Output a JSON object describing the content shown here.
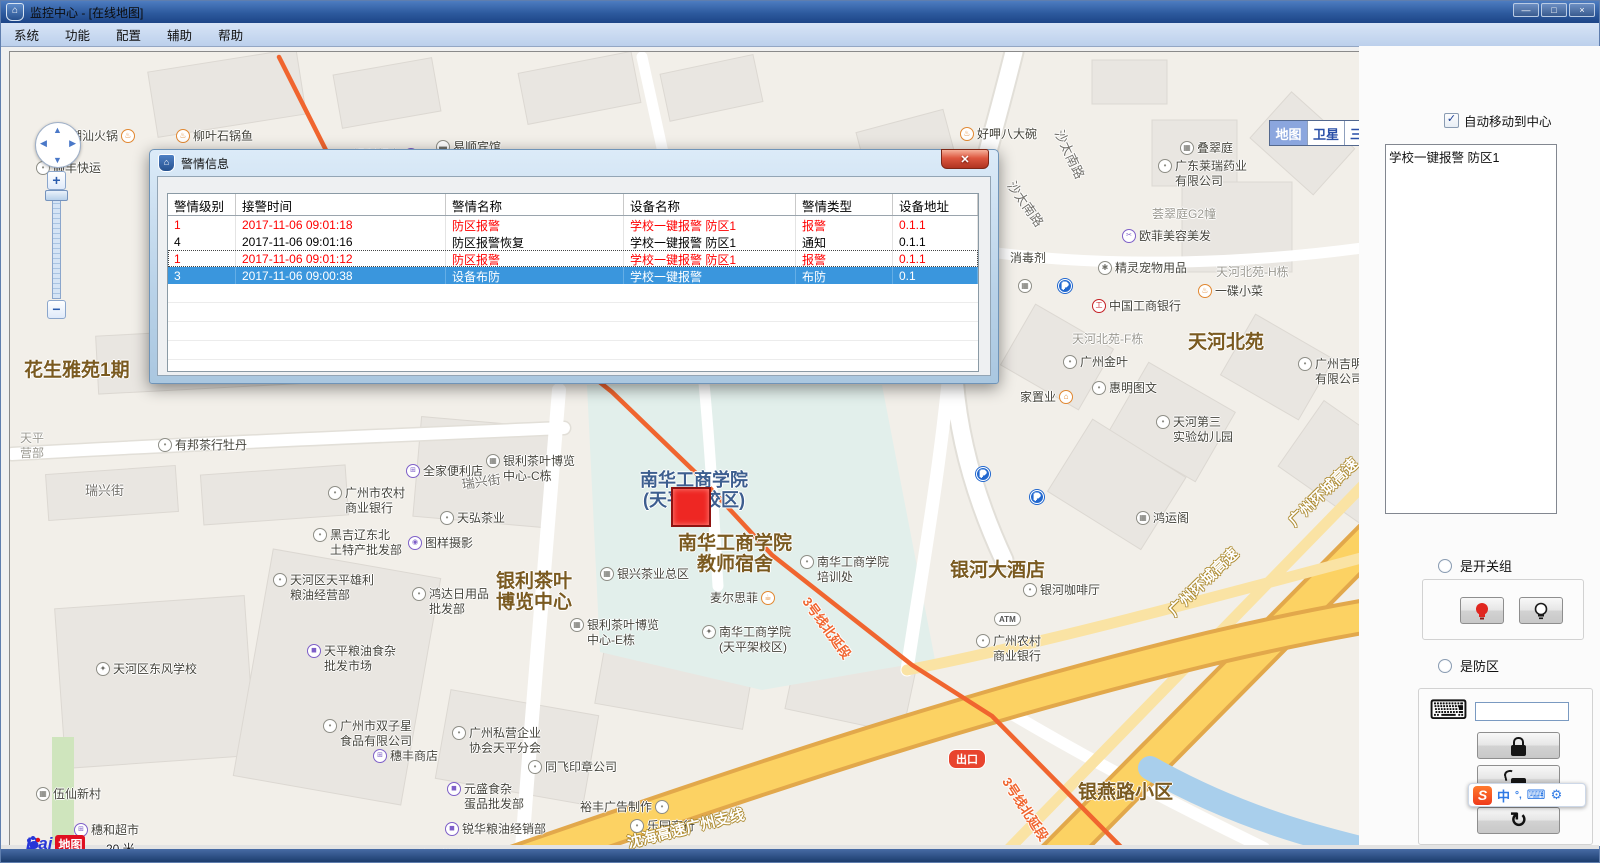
{
  "window": {
    "title": "监控中心 - [在线地图]",
    "controls": {
      "minimize": "—",
      "maximize": "□",
      "close": "×"
    }
  },
  "menu": {
    "items": [
      "系统",
      "功能",
      "配置",
      "辅助",
      "帮助"
    ]
  },
  "map": {
    "view_buttons": [
      {
        "label": "地图",
        "active": true
      },
      {
        "label": "卫星",
        "active": false
      },
      {
        "label": "三维",
        "active": false
      }
    ],
    "zoom_plus": "+",
    "zoom_minus": "−",
    "logo": {
      "bai": "Bai",
      "ditu": "地图"
    },
    "scale_label": "20 米",
    "copyright": "© 2017 Baidu - GS(2016)2089号 - 甲测资字1100930 - 京ICP证030173号 - Data © 长地万方",
    "marker_color": "#ee2723",
    "metro_color": "#f0652f",
    "highway_color": "#fcd263",
    "labels": [
      {
        "t": "潮汕火锅",
        "x": 60,
        "y": 86,
        "i": "food",
        "s": "r"
      },
      {
        "t": "柳叶石锅鱼",
        "x": 166,
        "y": 86,
        "i": "food"
      },
      {
        "t": "顺丰快运",
        "x": 26,
        "y": 118,
        "i": "dot"
      },
      {
        "t": "点心哥哥",
        "x": 196,
        "y": 133,
        "i": "food",
        "s": "r"
      },
      {
        "t": "美宜佳",
        "x": 282,
        "y": 145,
        "i": "bag",
        "s": "r"
      },
      {
        "t": "银利超市",
        "x": 343,
        "y": 105,
        "i": "bag",
        "s": "r"
      },
      {
        "t": "名城休闲会所",
        "x": 348,
        "y": 131,
        "i": "dot"
      },
      {
        "t": "易顺宾馆",
        "x": 426,
        "y": 97,
        "i": "bed"
      },
      {
        "t": "老三修理店",
        "x": 528,
        "y": 109,
        "i": "car"
      },
      {
        "t": "化隆牛肉面",
        "x": 556,
        "y": 143,
        "i": "food"
      },
      {
        "t": "好呷八大碗",
        "x": 950,
        "y": 84,
        "i": "food"
      },
      {
        "t": "叠翠庭",
        "x": 1170,
        "y": 98,
        "i": "bld"
      },
      {
        "t": "广东莱瑞药业\n有限公司",
        "x": 1148,
        "y": 116,
        "i": "dot"
      },
      {
        "t": "荟翠庭G2幢",
        "x": 1142,
        "y": 164,
        "c": "gray"
      },
      {
        "t": "欧菲美容美发",
        "x": 1112,
        "y": 186,
        "i": "cut"
      },
      {
        "t": "消毒剂",
        "x": 1000,
        "y": 208
      },
      {
        "t": "精灵宠物用品",
        "x": 1088,
        "y": 218,
        "i": "paw"
      },
      {
        "t": "天河北苑-H栋",
        "x": 1206,
        "y": 222,
        "c": "gray"
      },
      {
        "t": "一碟小菜",
        "x": 1188,
        "y": 241,
        "i": "food"
      },
      {
        "t": "中国工商银行",
        "x": 1082,
        "y": 256,
        "i": "icbc"
      },
      {
        "t": "天河北苑-F栋",
        "x": 1062,
        "y": 289,
        "c": "gray"
      },
      {
        "t": "天河北苑",
        "x": 1178,
        "y": 290,
        "c": "big"
      },
      {
        "t": "广州金叶",
        "x": 1053,
        "y": 312,
        "i": "dot"
      },
      {
        "t": "惠明图文",
        "x": 1082,
        "y": 338,
        "i": "dot"
      },
      {
        "t": "家置业",
        "x": 1010,
        "y": 347,
        "i": "home",
        "s": "r"
      },
      {
        "t": "天河第三\n实验幼儿园",
        "x": 1146,
        "y": 372,
        "i": "dot"
      },
      {
        "t": "广州吉明电子科技\n有限公司",
        "x": 1288,
        "y": 314,
        "i": "dot"
      },
      {
        "t": "鸿运阁",
        "x": 1126,
        "y": 468,
        "i": "bld"
      },
      {
        "t": "花生雅苑1期",
        "x": 14,
        "y": 318,
        "c": "big"
      },
      {
        "t": "天平\n营部",
        "x": 10,
        "y": 388,
        "c": "gray"
      },
      {
        "t": "瑞兴街",
        "x": 75,
        "y": 440,
        "c": "road"
      },
      {
        "t": "瑞兴街",
        "x": 452,
        "y": 434,
        "c": "road",
        "r": -8
      },
      {
        "t": "有邦茶行牡丹",
        "x": 148,
        "y": 395,
        "i": "dot"
      },
      {
        "t": "广州市农村\n商业银行",
        "x": 318,
        "y": 443,
        "i": "dot"
      },
      {
        "t": "黑吉辽东北\n土特产批发部",
        "x": 303,
        "y": 485,
        "i": "dot"
      },
      {
        "t": "天河区天平雄利\n粮油经营部",
        "x": 263,
        "y": 530,
        "i": "dot"
      },
      {
        "t": "全家便利店",
        "x": 396,
        "y": 421,
        "i": "cart"
      },
      {
        "t": "银利茶叶博览\n中心-C栋",
        "x": 476,
        "y": 411,
        "i": "bld"
      },
      {
        "t": "天弘茶业",
        "x": 430,
        "y": 468,
        "i": "dot"
      },
      {
        "t": "图样摄影",
        "x": 398,
        "y": 493,
        "i": "camera"
      },
      {
        "t": "银利茶叶\n博览中心",
        "x": 486,
        "y": 529,
        "c": "big"
      },
      {
        "t": "鸿达日用品\n批发部",
        "x": 402,
        "y": 544,
        "i": "dot"
      },
      {
        "t": "银兴茶业总区",
        "x": 590,
        "y": 524,
        "i": "bld"
      },
      {
        "t": "银利茶叶博览\n中心-E栋",
        "x": 560,
        "y": 575,
        "i": "bld"
      },
      {
        "t": "南华工商学院\n(天平架校区)",
        "x": 630,
        "y": 427,
        "c": "big2"
      },
      {
        "t": "南华工商学院\n教师宿舍",
        "x": 668,
        "y": 491,
        "c": "big"
      },
      {
        "t": "麦尔思菲",
        "x": 700,
        "y": 548,
        "i": "coffee",
        "s": "r"
      },
      {
        "t": "南华工商学院\n培训处",
        "x": 790,
        "y": 512,
        "i": "dot"
      },
      {
        "t": "南华工商学院\n(天平架校区)",
        "x": 692,
        "y": 582,
        "i": "school"
      },
      {
        "t": "银河大酒店",
        "x": 940,
        "y": 518,
        "c": "big"
      },
      {
        "t": "银河咖啡厅",
        "x": 1013,
        "y": 540,
        "i": "dot"
      },
      {
        "t": "广州农村\n商业银行",
        "x": 966,
        "y": 591,
        "i": "dot"
      },
      {
        "t": "天平粮油食杂\n批发市场",
        "x": 297,
        "y": 601,
        "i": "bag"
      },
      {
        "t": "广州市双子星\n食品有限公司",
        "x": 313,
        "y": 676,
        "i": "dot"
      },
      {
        "t": "穗丰商店",
        "x": 363,
        "y": 706,
        "i": "cart"
      },
      {
        "t": "广州私营企业\n协会天平分会",
        "x": 442,
        "y": 683,
        "i": "dot"
      },
      {
        "t": "同飞印章公司",
        "x": 518,
        "y": 717,
        "i": "dot"
      },
      {
        "t": "元盛食杂\n蛋品批发部",
        "x": 437,
        "y": 739,
        "i": "bag"
      },
      {
        "t": "裕丰广告制作",
        "x": 570,
        "y": 757,
        "i": "dot",
        "s": "r"
      },
      {
        "t": "锐华粮油经销部",
        "x": 435,
        "y": 779,
        "i": "bag"
      },
      {
        "t": "乐园商行",
        "x": 620,
        "y": 776,
        "i": "dot"
      },
      {
        "t": "锋兴批发部",
        "x": 390,
        "y": 806,
        "i": "bag"
      },
      {
        "t": "天河区东风学校",
        "x": 86,
        "y": 619,
        "i": "school"
      },
      {
        "t": "伍仙新村",
        "x": 26,
        "y": 744,
        "i": "bld"
      },
      {
        "t": "穗和超市",
        "x": 64,
        "y": 780,
        "i": "cart"
      },
      {
        "t": "永业汽配经营部",
        "x": 872,
        "y": 812,
        "i": "car"
      },
      {
        "t": "新蕾五星学校",
        "x": 860,
        "y": 837,
        "c": "big"
      },
      {
        "t": "银燕路小区",
        "x": 1068,
        "y": 740,
        "c": "big"
      },
      {
        "t": "3号线北延段",
        "x": 795,
        "y": 548,
        "c": "metro",
        "r": 54
      },
      {
        "t": "3号线北延段",
        "x": 995,
        "y": 728,
        "c": "metro",
        "r": 57
      },
      {
        "t": "沈海高速广州支线",
        "x": 618,
        "y": 792,
        "c": "hwy",
        "r": -14
      },
      {
        "t": "广州环城高速",
        "x": 1162,
        "y": 562,
        "c": "hwy",
        "r": -44
      },
      {
        "t": "广州环城高速",
        "x": 1282,
        "y": 472,
        "c": "hwy",
        "r": -44
      },
      {
        "t": "沙太南路",
        "x": 1048,
        "y": 80,
        "c": "road",
        "r": 65
      },
      {
        "t": "沙太南路",
        "x": 1000,
        "y": 132,
        "c": "road",
        "r": 55
      },
      {
        "t": "",
        "x": 1008,
        "y": 236,
        "i": "bld"
      },
      {
        "t": "",
        "x": 1048,
        "y": 236,
        "i": "p"
      },
      {
        "t": "",
        "x": 966,
        "y": 424,
        "i": "p"
      },
      {
        "t": "",
        "x": 1020,
        "y": 447,
        "i": "p"
      }
    ],
    "atm_badge": {
      "t": "ATM",
      "x": 984,
      "y": 560
    },
    "exit_badge": {
      "t": "出口",
      "x": 938,
      "y": 697
    }
  },
  "dialog": {
    "title": "警情信息",
    "close_glyph": "✕",
    "columns": [
      "警情级别",
      "接警时间",
      "警情名称",
      "设备名称",
      "警情类型",
      "设备地址"
    ],
    "col_widths": [
      68,
      210,
      178,
      172,
      97,
      85
    ],
    "rows": [
      {
        "cells": [
          "1",
          "2017-11-06 09:01:18",
          "防区报警",
          "学校一键报警 防区1",
          "报警",
          "0.1.1"
        ],
        "style": "alarm"
      },
      {
        "cells": [
          "4",
          "2017-11-06 09:01:16",
          "防区报警恢复",
          "学校一键报警 防区1",
          "通知",
          "0.1.1"
        ],
        "style": "normal"
      },
      {
        "cells": [
          "1",
          "2017-11-06 09:01:12",
          "防区报警",
          "学校一键报警 防区1",
          "报警",
          "0.1.1"
        ],
        "style": "alarm focused"
      },
      {
        "cells": [
          "3",
          "2017-11-06 09:00:38",
          "设备布防",
          "学校一键报警",
          "布防",
          "0.1"
        ],
        "style": "selected"
      }
    ],
    "empty_row_count": 5
  },
  "sidebar": {
    "auto_center_label": "自动移动到中心",
    "auto_center_checked": true,
    "check_glyph": "✓",
    "device_list": [
      "学校一键报警 防区1"
    ],
    "switch_group_label": "是开关组",
    "zone_label": "是防区",
    "zone_input_value": "",
    "keyboard_glyph": "⌨",
    "reset_glyph": "↻"
  },
  "ime": {
    "logo": "S",
    "lang": "中",
    "punct": "°,",
    "kb": "⌨",
    "tool": "⚙"
  }
}
